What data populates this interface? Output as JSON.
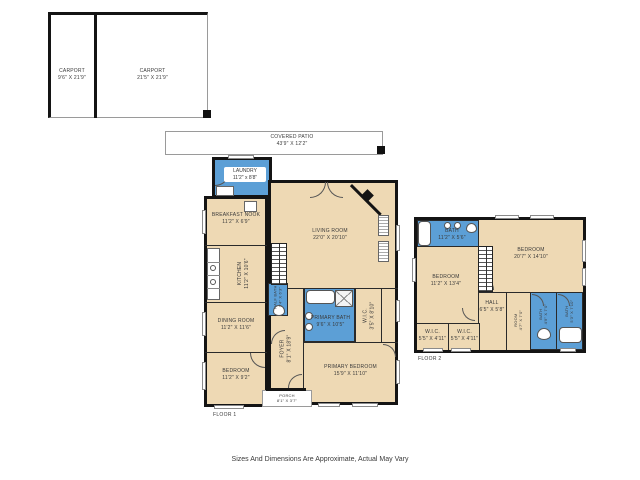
{
  "colors": {
    "room_fill": "#eed9b4",
    "wet_room_fill": "#5c9fd6",
    "wall": "#141414"
  },
  "footer": {
    "disclaimer": "Sizes And Dimensions Are Approximate, Actual May Vary"
  },
  "floor1": {
    "label": "FLOOR 1",
    "carport_left": {
      "name": "CARPORT",
      "dims": "9'6\" X 21'9\""
    },
    "carport_right": {
      "name": "CARPORT",
      "dims": "21'5\" X 21'9\""
    },
    "patio": {
      "name": "COVERED PATIO",
      "dims": "43'9\" X 12'2\""
    },
    "laundry": {
      "name": "LAUNDRY",
      "dims": "11'2\" x 8'8\""
    },
    "breakfast": {
      "name": "BREAKFAST NOOK",
      "dims": "11'2\" X 6'9\""
    },
    "living": {
      "name": "LIVING ROOM",
      "dims": "22'0\" X 20'10\""
    },
    "kitchen": {
      "name": "KITCHEN",
      "dims": "11'2\" X 10'6\""
    },
    "dining": {
      "name": "DINING ROOM",
      "dims": "11'2\" X 11'6\""
    },
    "half_bath": {
      "name": "HALF BATH",
      "dims": "3'4\" X 6'3\""
    },
    "foyer": {
      "name": "FOYER",
      "dims": "8'1\" X 18'9\""
    },
    "primary_bath": {
      "name": "PRIMARY BATH",
      "dims": "9'6\" X 10'5\""
    },
    "wic": {
      "name": "W.I.C.",
      "dims": "3'5\" X 8'10\""
    },
    "primary_bedroom": {
      "name": "PRIMARY BEDROOM",
      "dims": "15'9\" X 11'10\""
    },
    "bedroom": {
      "name": "BEDROOM",
      "dims": "11'2\" X 9'2\""
    },
    "porch": {
      "name": "PORCH",
      "dims": "8'1\" X 3'7\""
    }
  },
  "floor2": {
    "label": "FLOOR 2",
    "bath_top": {
      "name": "BATH",
      "dims": "11'2\" X 5'6\""
    },
    "bedroom_large": {
      "name": "BEDROOM",
      "dims": "20'7\" X 14'10\""
    },
    "bedroom_left": {
      "name": "BEDROOM",
      "dims": "11'2\" X 13'4\""
    },
    "hall": {
      "name": "HALL",
      "dims": "6'5\" X 5'8\""
    },
    "wic_a": {
      "name": "W.I.C.",
      "dims": "5'5\" X 4'11\""
    },
    "wic_b": {
      "name": "W.I.C.",
      "dims": "5'5\" X 4'11\""
    },
    "room": {
      "name": "ROOM",
      "dims": "4'7\" X 7'0\""
    },
    "bath_mid": {
      "name": "BATH",
      "dims": "4'9\" X 7'0\""
    },
    "bath_right": {
      "name": "BATH",
      "dims": "5'3\" X 7'10\""
    }
  }
}
